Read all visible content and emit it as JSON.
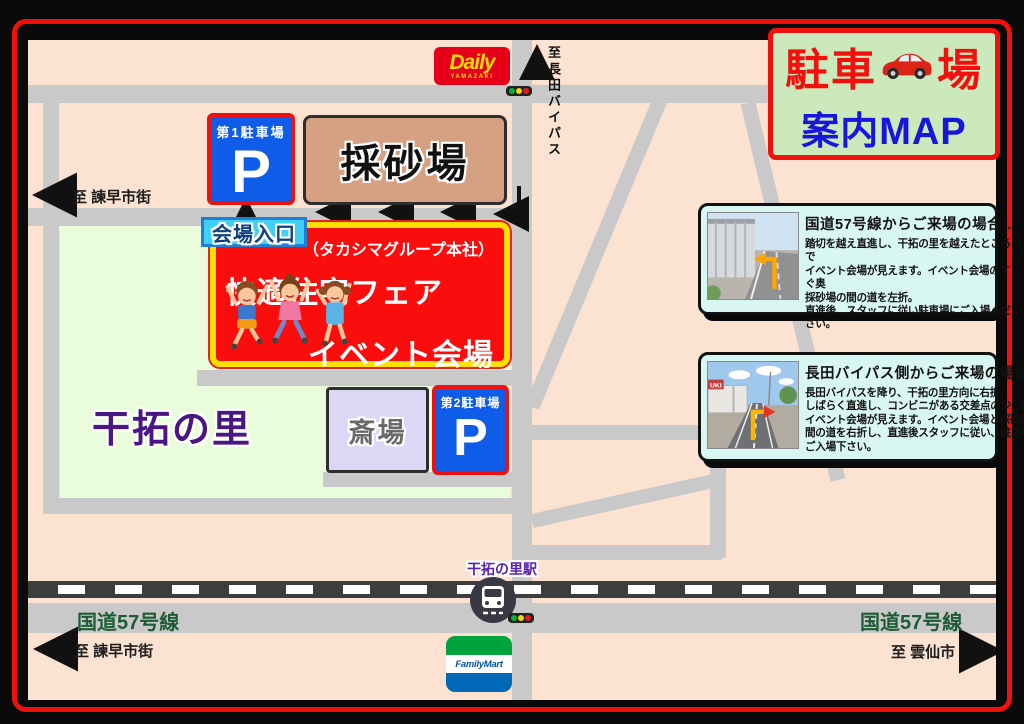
{
  "theme": {
    "accent-red": "#f1100c",
    "map-bg": "#fbe2d1",
    "road-gray": "#c9c9c9",
    "green-zone": "#e9fcdc",
    "rail-dark": "#3d3d3d",
    "p-blue": "#0f5ce8",
    "p-border-red": "#ee1111",
    "event-red": "#f90d0d",
    "event-yellow": "#ffe000",
    "entrance-cyan": "#3fd0f5",
    "title-bg": "#cbe9ba",
    "title-blue": "#1616dd",
    "panel-bg": "#d8f6f2",
    "route-green": "#1d5c36",
    "station-purple": "#5a1fb5",
    "kantaku-purple": "#4a1684",
    "daily-red": "#e50017",
    "daily-yellow": "#ffdc00",
    "fm-green": "#00a33e",
    "fm-blue": "#0068b7",
    "sand-tan": "#d6a182",
    "saijo-lav": "#dcd7f5"
  },
  "title_panel": {
    "line1_left": "駐車",
    "line1_right": "場",
    "line2": "案内MAP"
  },
  "stores": {
    "daily": {
      "name": "Daily",
      "sub": "YAMAZAKI"
    },
    "familymart": {
      "name": "FamilyMart"
    }
  },
  "map_labels": {
    "bypass_prefix": "至",
    "bypass_name": "長田バイパス",
    "to_isahaya_top": "至 諫早市街",
    "to_isahaya_bottom": "至 諫早市街",
    "to_unzen": "至 雲仙市",
    "route57_left": "国道57号線",
    "route57_right": "国道57号線",
    "kantaku_no_sato": "干拓の里",
    "station": "干拓の里駅"
  },
  "places": {
    "parking1": {
      "label": "第1駐車場",
      "symbol": "P"
    },
    "parking2": {
      "label": "第2駐車場",
      "symbol": "P"
    },
    "sand_pit": "採砂場",
    "funeral_hall": "斎場",
    "venue_entrance": "会場入口",
    "event": {
      "company": "（タカシマグループ本社）",
      "fair": "快適住宅フェア",
      "venue": "イベント会場"
    }
  },
  "info_panels": [
    {
      "title": "国道57号線からご来場の場合…",
      "body": [
        "踏切を越え直進し、干拓の里を越えたところで",
        "イベント会場が見えます。イベント会場のすぐ奥",
        "採砂場の間の道を左折。",
        "直進後、スタッフに従い駐車場にご入場ください。"
      ]
    },
    {
      "title": "長田バイパス側からご来場の場合…",
      "body": [
        "長田バイパスを降り、干拓の里方向に右折。",
        "しばらく直進し、コンビニがある交差点の少し先に",
        "イベント会場が見えます。イベント会場と採砂場の",
        "間の道を右折し、直進後スタッフに従い、駐車場に",
        "ご入場下さい。"
      ],
      "photo_sign": "UKI"
    }
  ]
}
